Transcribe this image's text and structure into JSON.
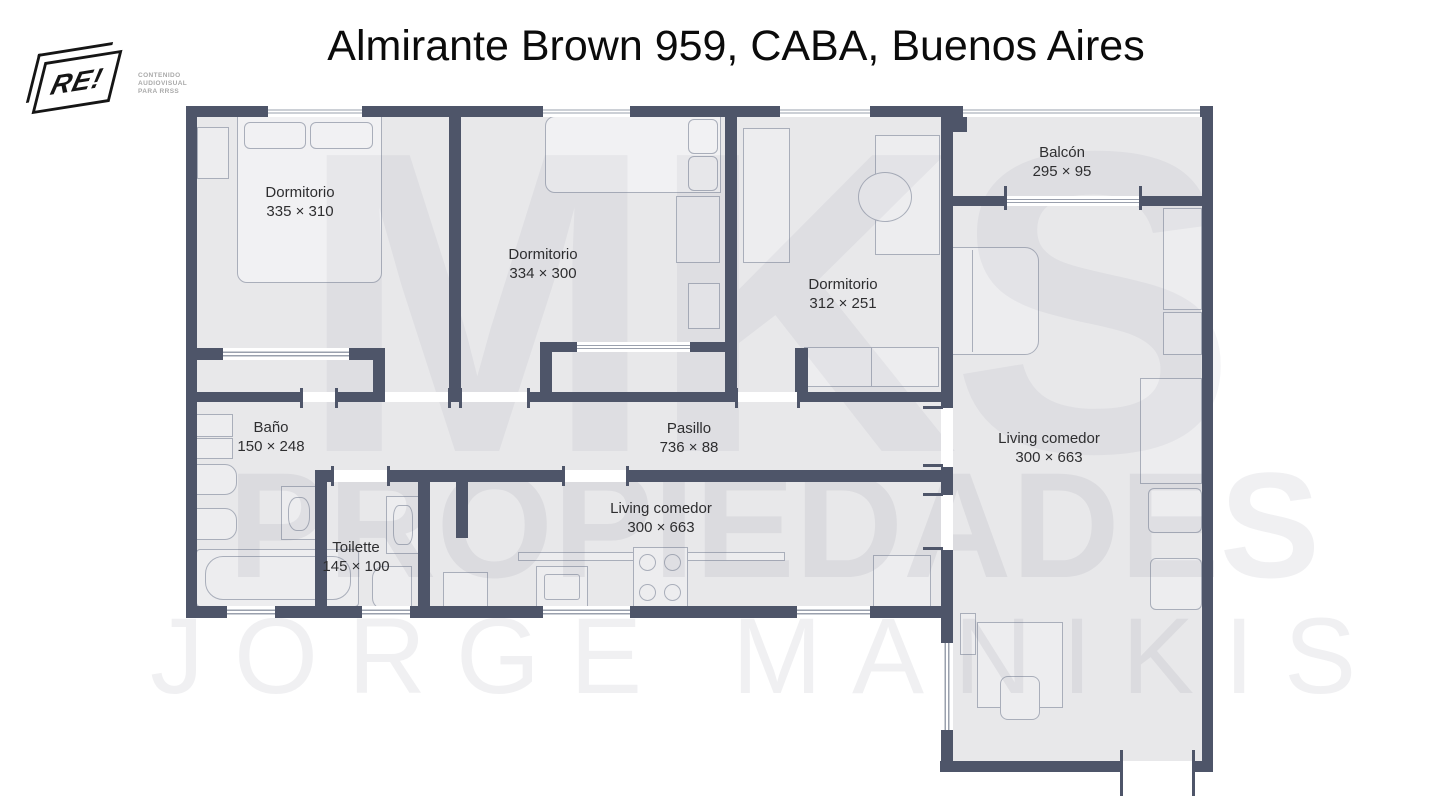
{
  "header": {
    "title": "Almirante Brown 959, CABA, Buenos Aires",
    "logo": {
      "text": "RE",
      "bang": "!",
      "tagline_lines": [
        "CONTENIDO",
        "AUDIOVISUAL",
        "PARA RRSS"
      ]
    }
  },
  "watermark": {
    "line1": "MKS",
    "line2": "PROPIEDADES",
    "line3": "JORGE MANIKIS"
  },
  "floorplan": {
    "rooms": [
      {
        "id": "dormitorio-1",
        "name": "Dormitorio",
        "dims": "335 × 310"
      },
      {
        "id": "dormitorio-2",
        "name": "Dormitorio",
        "dims": "334 × 300"
      },
      {
        "id": "dormitorio-3",
        "name": "Dormitorio",
        "dims": "312 × 251"
      },
      {
        "id": "balcon",
        "name": "Balcón",
        "dims": "295 × 95"
      },
      {
        "id": "bano",
        "name": "Baño",
        "dims": "150 × 248"
      },
      {
        "id": "toilette",
        "name": "Toilette",
        "dims": "145 × 100"
      },
      {
        "id": "pasillo",
        "name": "Pasillo",
        "dims": "736 × 88"
      },
      {
        "id": "living-comedor-cocina",
        "name": "Living comedor",
        "dims": "300 × 663"
      },
      {
        "id": "living-comedor",
        "name": "Living comedor",
        "dims": "300 × 663"
      }
    ],
    "colors": {
      "wall": "#4e5569",
      "floor": "#e8e8ea",
      "furniture_line": "#a9aeba",
      "label": "#2e2e30"
    }
  }
}
